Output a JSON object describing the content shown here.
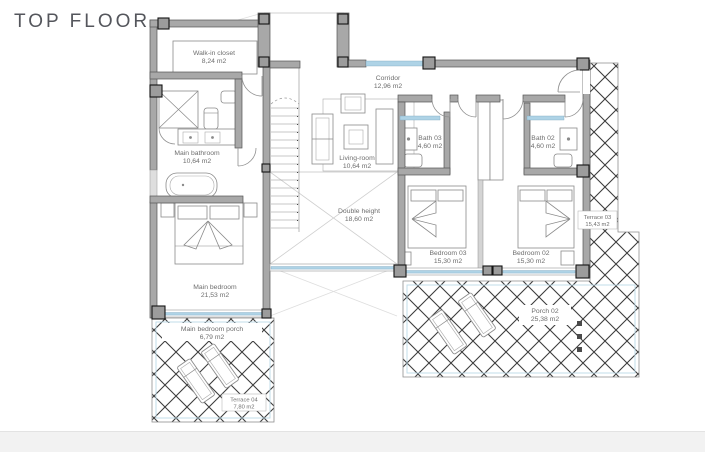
{
  "title": "TOP FLOOR",
  "plan": {
    "rooms": [
      {
        "id": "walk-in-closet",
        "name": "Walk-in closet",
        "area": "8,24 m2"
      },
      {
        "id": "main-bathroom",
        "name": "Main bathroom",
        "area": "10,64 m2"
      },
      {
        "id": "corridor",
        "name": "Corridor",
        "area": "12,96 m2"
      },
      {
        "id": "living-room",
        "name": "Living-room",
        "area": "10,64 m2"
      },
      {
        "id": "bath-03",
        "name": "Bath 03",
        "area": "4,60 m2"
      },
      {
        "id": "bath-02",
        "name": "Bath 02",
        "area": "4,60 m2"
      },
      {
        "id": "double-height",
        "name": "Double height",
        "area": "18,60 m2"
      },
      {
        "id": "bedroom-03",
        "name": "Bedroom 03",
        "area": "15,30 m2"
      },
      {
        "id": "bedroom-02",
        "name": "Bedroom 02",
        "area": "15,30 m2"
      },
      {
        "id": "terrace-03",
        "name": "Terrace 03",
        "area": "15,43 m2"
      },
      {
        "id": "main-bedroom",
        "name": "Main bedroom",
        "area": "21,53 m2"
      },
      {
        "id": "main-bedroom-porch",
        "name": "Main bedroom porch",
        "area": "6,79 m2"
      },
      {
        "id": "terrace-04",
        "name": "Terrace 04",
        "area": "7,80 m2"
      },
      {
        "id": "porch-02",
        "name": "Porch 02",
        "area": "25,38 m2"
      }
    ],
    "colors": {
      "wall": "#a8a8a8",
      "wall_outline": "#555555",
      "glazing": "#aed3e6",
      "hatch": "#3d3d3d",
      "label_text": "#6e6e6e",
      "title_text": "#54565c",
      "footer_strip": "#f2f2f2"
    }
  }
}
